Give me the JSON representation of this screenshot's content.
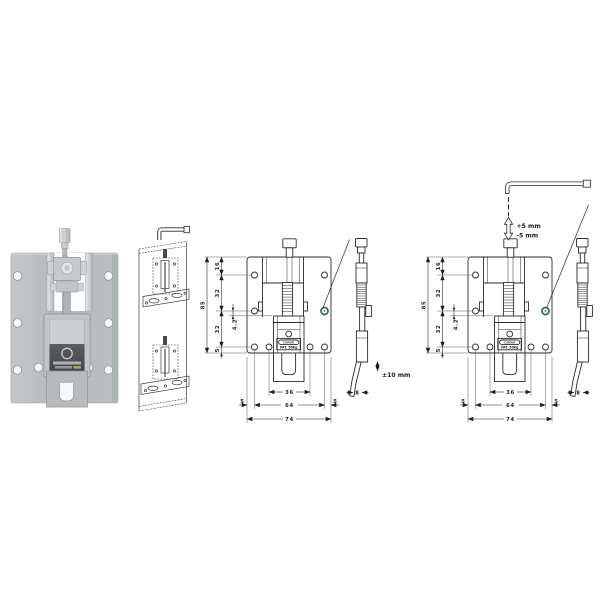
{
  "figure": {
    "background": "#ffffff",
    "line_color": "#2b2b2b",
    "accent_green": "#356e58",
    "description_items": [
      "product-photo",
      "installation-sketch",
      "dimensioned-front-view",
      "side-profile-view",
      "adjustment-view"
    ]
  },
  "dimensions": {
    "height_total": "85",
    "top_to_hole": "16",
    "hole_spacing_upper": "32",
    "hole_spacing_lower": "32",
    "hole_to_bottom": "5",
    "hole_diameter": "4.2",
    "slot_width": "36",
    "edge_left": "5",
    "hole_span": "64",
    "edge_right": "5",
    "width_total": "74",
    "thickness": "8"
  },
  "annotations": {
    "vertical_travel": "±10 mm",
    "adjust_up": "+5 mm",
    "adjust_down": "-5 mm"
  },
  "plate_label": {
    "brand": "CAMAR",
    "capacity": "PAT. 50Kg"
  }
}
